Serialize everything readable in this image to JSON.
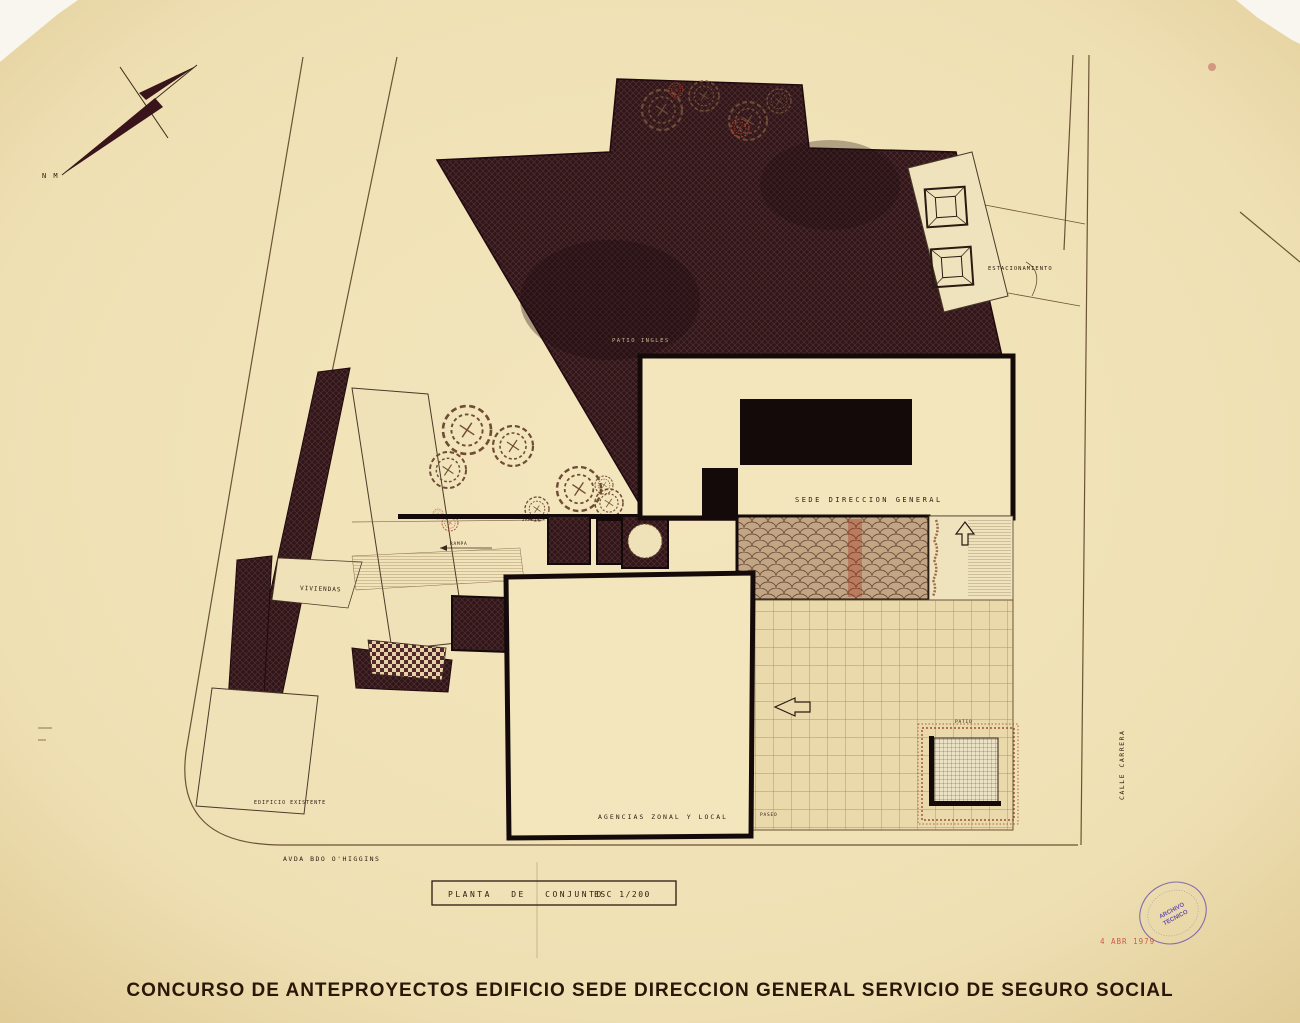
{
  "document": {
    "main_title": "CONCURSO DE ANTEPROYECTOS EDIFICIO SEDE DIRECCION GENERAL SERVICIO DE SEGURO SOCIAL",
    "title_block": {
      "drawing_name": "PLANTA DE CONJUNTO",
      "scale": "ESC 1/200"
    },
    "compass_label": "N M"
  },
  "plan_labels": {
    "sede": "SEDE DIRECCION GENERAL",
    "agencias": "AGENCIAS ZONAL Y LOCAL",
    "viviendas": "VIVIENDAS",
    "edificio_existente": "EDIFICIO EXISTENTE",
    "patio_ingles": "PATIO INGLES",
    "estacionamiento": "ESTACIONAMIENTO",
    "rampa": "RAMPA",
    "jardin": "JARDIN",
    "paseo": "PASEO",
    "patio": "PATIO",
    "avenida": "AVDA  BDO  O'HIGGINS",
    "calle": "CALLE  CARRERA"
  },
  "stamps": {
    "archive_line1": "ARCHIVO",
    "archive_line2": "TECNICO",
    "date": "4 ABR 1979"
  },
  "colors": {
    "paper": "#efe0b4",
    "ink_dark": "#1d0f0f",
    "hatch_base": "#31151a",
    "red_accent": "#b5432c",
    "purple_stamp": "#6a4fae"
  }
}
